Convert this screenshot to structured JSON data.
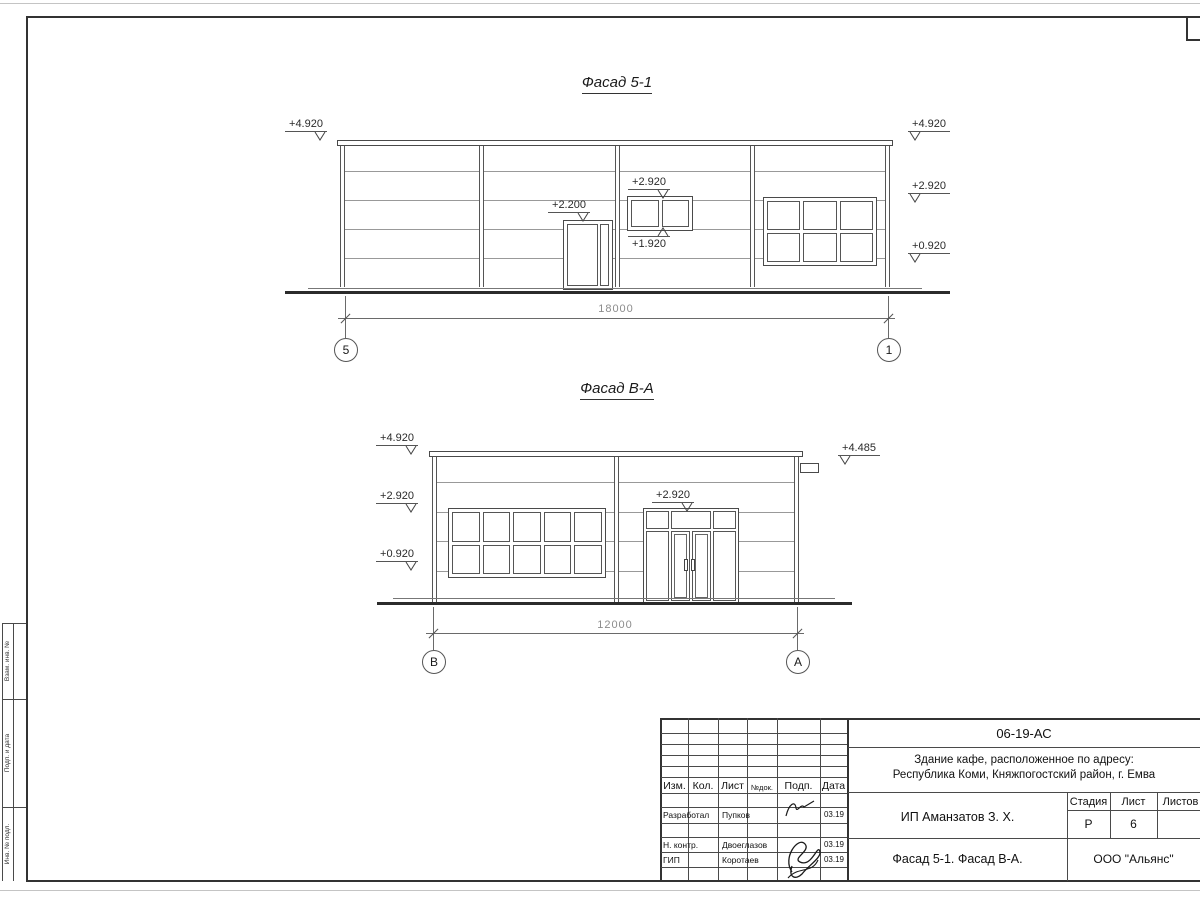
{
  "sheet": {
    "f1": {
      "title": "Фасад 5-1",
      "dim": "18000",
      "axis_left": "5",
      "axis_right": "1",
      "ev_left_top": "+4.920",
      "ev_right_top": "+4.920",
      "ev_right_mid": "+2.920",
      "ev_right_bot": "+0.920",
      "ev_door": "+2.200",
      "ev_win_top": "+2.920",
      "ev_win_bot": "+1.920"
    },
    "f2": {
      "title": "Фасад В-А",
      "dim": "12000",
      "axis_left": "В",
      "axis_right": "А",
      "ev_left_top": "+4.920",
      "ev_left_mid": "+2.920",
      "ev_left_bot": "+0.920",
      "ev_canopy": "+4.485",
      "ev_door": "+2.920"
    }
  },
  "titleblock": {
    "doc_number": "06-19-АС",
    "project_line1": "Здание кафе, расположенное по адресу:",
    "project_line2": "Республика Коми, Княжпогостский район, г. Емва",
    "client": "ИП Аманзатов З. Х.",
    "sheet_name": "Фасад 5-1. Фасад В-А.",
    "company": "ООО \"Альянс\"",
    "stage": {
      "labels": [
        "Стадия",
        "Лист",
        "Листов"
      ],
      "stage_value": "Р",
      "sheet_value": "6"
    },
    "cols": [
      "Изм.",
      "Кол.",
      "Лист",
      "№док.",
      "Подп.",
      "Дата"
    ],
    "rows": [
      {
        "role": "Разработал",
        "name": "Пупков",
        "date": "03.19"
      },
      {
        "role": "Н. контр.",
        "name": "Двоеглазов",
        "date": "03.19"
      },
      {
        "role": "ГИП",
        "name": "Коротаев",
        "date": "03.19"
      }
    ]
  },
  "margin_stamp": {
    "cells": [
      "Взам. инв. №",
      "Подп. и дата",
      "Инв. № подл."
    ]
  }
}
